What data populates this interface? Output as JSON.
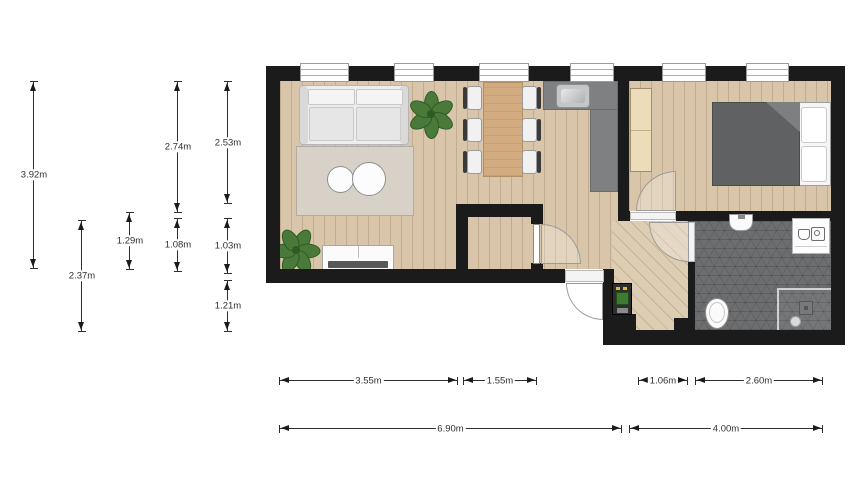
{
  "floorplan": {
    "unit": "m",
    "dimensions": {
      "vertical": [
        {
          "label": "3.92m"
        },
        {
          "label": "2.37m"
        },
        {
          "label": "1.29m"
        },
        {
          "label": "2.74m"
        },
        {
          "label": "1.08m"
        },
        {
          "label": "2.53m"
        },
        {
          "label": "1.03m"
        },
        {
          "label": "1.21m"
        }
      ],
      "horizontal": [
        {
          "label": "3.55m"
        },
        {
          "label": "1.55m"
        },
        {
          "label": "1.06m"
        },
        {
          "label": "2.60m"
        },
        {
          "label": "6.90m"
        },
        {
          "label": "4.00m"
        }
      ]
    },
    "colors": {
      "wall": "#1b1b1b",
      "wood": "#d9c6aa",
      "hall_wood": "#dccdb3",
      "bathroom_tile": "#6c6e70",
      "counter": "#7e8081",
      "rug": "#d8d1c8",
      "bed_duvet": "#5f6163",
      "wardrobe": "#ecdcba",
      "table_wood": "#d2ab81",
      "plant": "#4a7a3a"
    }
  }
}
